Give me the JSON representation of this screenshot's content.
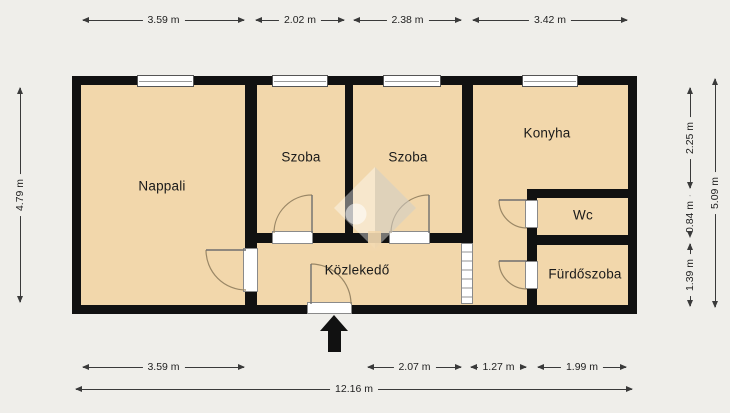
{
  "colors": {
    "background": "#efeeea",
    "room_fill": "#f2d7ab",
    "wall": "#111111",
    "dimension_line": "#3a3a3a",
    "door_arc": "#9a8766"
  },
  "rooms": [
    {
      "label": "Nappali"
    },
    {
      "label": "Szoba"
    },
    {
      "label": "Szoba"
    },
    {
      "label": "Konyha"
    },
    {
      "label": "Wc"
    },
    {
      "label": "Fürdőszoba"
    },
    {
      "label": "Közlekedő"
    }
  ],
  "dimensions": {
    "top": [
      "3.59 m",
      "2.02 m",
      "2.38 m",
      "3.42 m"
    ],
    "bottom": [
      "3.59 m",
      "2.07 m",
      "1.27 m",
      "1.99 m"
    ],
    "bottom_total": "12.16 m",
    "left": "4.79 m",
    "right": [
      "2.25 m",
      "0.84 m",
      "1.39 m"
    ],
    "right_total": "5.09 m"
  },
  "icons": {
    "entrance_arrow": "entrance-direction-up-arrow",
    "watermark": "house-logo-watermark"
  }
}
